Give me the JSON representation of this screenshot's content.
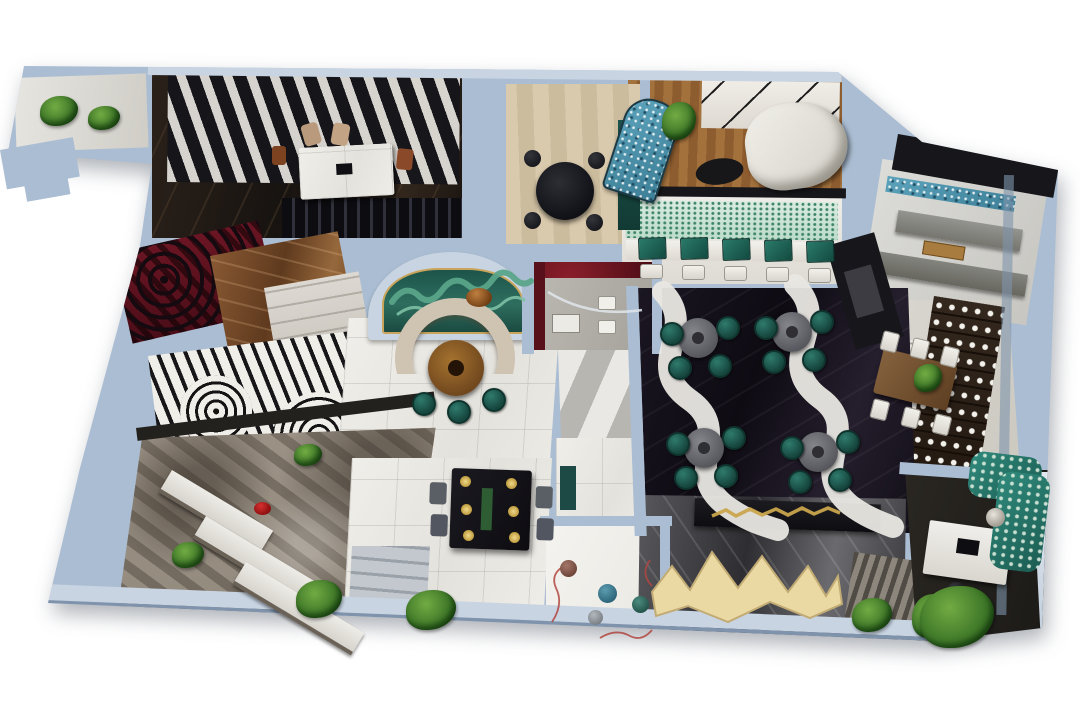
{
  "scene": {
    "type": "3d-cutaway-floorplan-render",
    "background": "#ffffff",
    "palette": {
      "wall": "#aabdd2",
      "wallLight": "#c8d4e2",
      "wallDark": "#7f94ac",
      "charcoal": "#17171b",
      "entryDark": "#221a14",
      "whiteMarble": "#eceae5",
      "cream": "#e9e6e0",
      "blackFloor": "#16121b",
      "beigeWood": "#d5c5a7",
      "wood": "#9c6c3e",
      "teal": "#1e5f55",
      "grayTable": "#77777e",
      "mosaic": "#4d93ac",
      "mural": "#245e52",
      "muralLight": "#5aa489",
      "copper": "#7c4e2c",
      "redCarpet": "#5d1220",
      "redWall": "#58101a",
      "stone": "#958b7f",
      "plant": "#3c7527",
      "plantLight": "#72ab43",
      "gold": "#c9a44c",
      "yellow": "#ead9a2",
      "rug": "#8c867c",
      "rugDark": "#504b44",
      "white": "#f4f3f0"
    },
    "regions": [
      "entry-gallery-wing",
      "entry-corridor-bar",
      "louvered-ceiling",
      "display-shelf-wall",
      "beige-dining-room",
      "curved-sofa-lounge",
      "mosaic-arch-screen",
      "zigzag-frame-wall",
      "booth-seating-row",
      "map-mural-wall",
      "pantry-bar-wing",
      "private-dining-room",
      "wine-display-shelf",
      "maze-pattern-rug",
      "red-carpet-room",
      "copper-marble-room",
      "white-cabinet-room",
      "op-art-floor-area",
      "mural-alcove",
      "semicircle-sofa",
      "round-tea-table",
      "restroom",
      "striped-vestibule",
      "black-marble-dining-hall",
      "white-ribbon-paths",
      "round-dining-tables",
      "stone-grotto-display",
      "display-counters",
      "white-marble-dining",
      "black-dining-table",
      "floral-painted-room",
      "gold-logo-wall",
      "yellow-fabric-sculpture",
      "striped-rug",
      "office-desk-room",
      "tropical-print-sofa",
      "plants"
    ],
    "furniture_counts": {
      "round-hall-tables": 4,
      "teal-chairs-per-table": 4,
      "booth-tables": 5,
      "grotto-counters": 3
    }
  }
}
